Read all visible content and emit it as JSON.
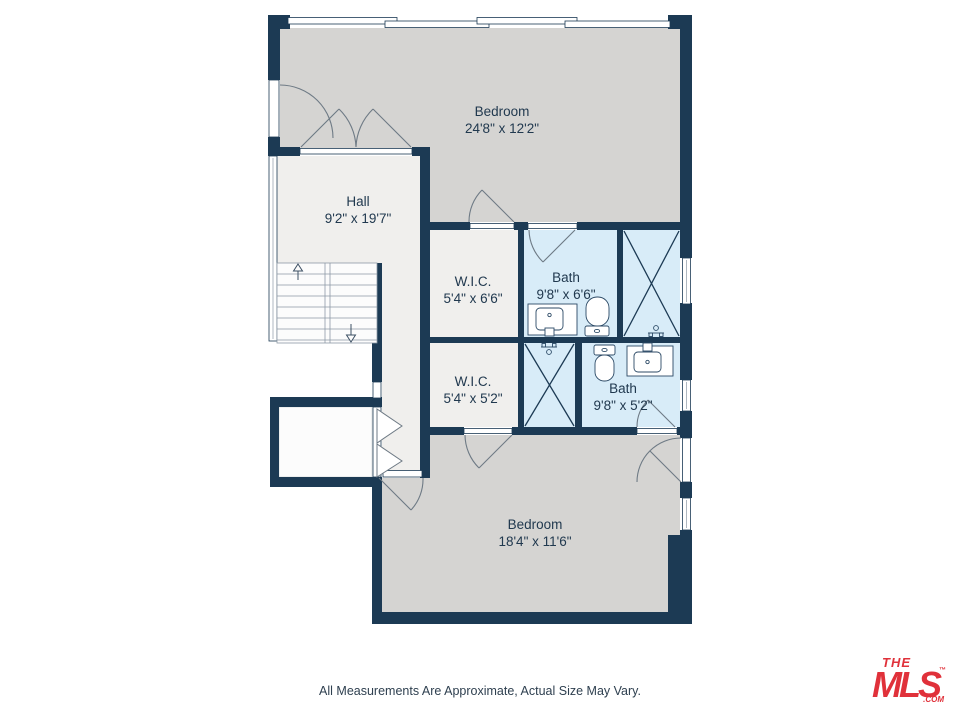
{
  "plan": {
    "rooms": [
      {
        "name": "Bedroom",
        "dims": "24'8\" x 12'2\""
      },
      {
        "name": "Hall",
        "dims": "9'2\" x 19'7\""
      },
      {
        "name": "W.I.C.",
        "dims": "5'4\" x 6'6\""
      },
      {
        "name": "Bath",
        "dims": "9'8\" x 6'6\""
      },
      {
        "name": "W.I.C.",
        "dims": "5'4\" x 5'2\""
      },
      {
        "name": "Bath",
        "dims": "9'8\" x 5'2\""
      },
      {
        "name": "Bedroom",
        "dims": "18'4\" x 11'6\""
      }
    ],
    "colors": {
      "wall": "#1c3a54",
      "bedroom_fill": "#d5d4d2",
      "hall_fill": "#f0efed",
      "bath_fill": "#d8ecf8",
      "closet_fill": "#fcfcfc",
      "label": "#21394f",
      "logo_red": "#e0313a"
    }
  },
  "footer": {
    "disclaimer": "All Measurements Are Approximate, Actual Size May Vary."
  },
  "logo": {
    "the": "THE",
    "mls": "MLS",
    "tm": "™",
    "com": ".COM"
  }
}
